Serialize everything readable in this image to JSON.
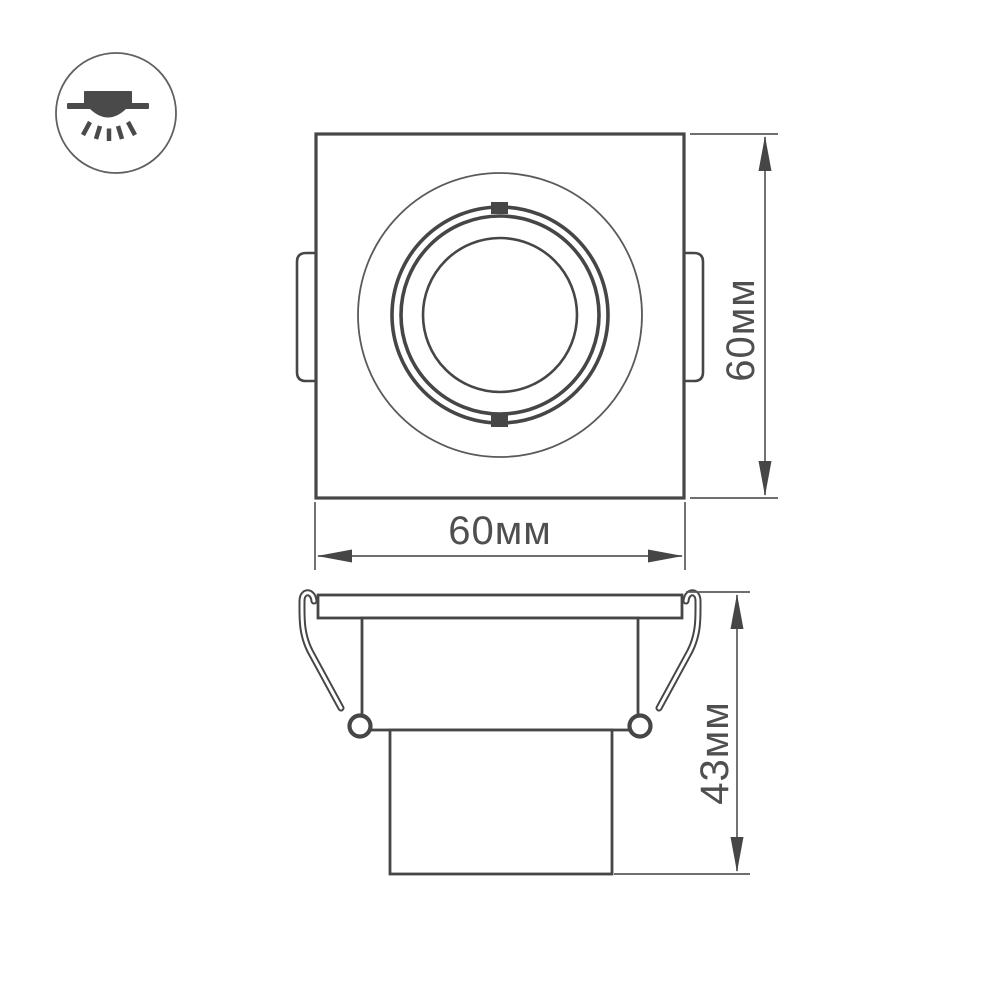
{
  "colors": {
    "line": "#464646",
    "thin_line": "#5a5a5a",
    "text": "#4f4f4f",
    "icon": "#4a4a4a",
    "background": "#ffffff"
  },
  "icon": {
    "symbol": "recessed-downlight"
  },
  "views": {
    "front": {
      "width_label": "60мм",
      "height_label": "60мм"
    },
    "side": {
      "height_label": "43мм"
    }
  }
}
